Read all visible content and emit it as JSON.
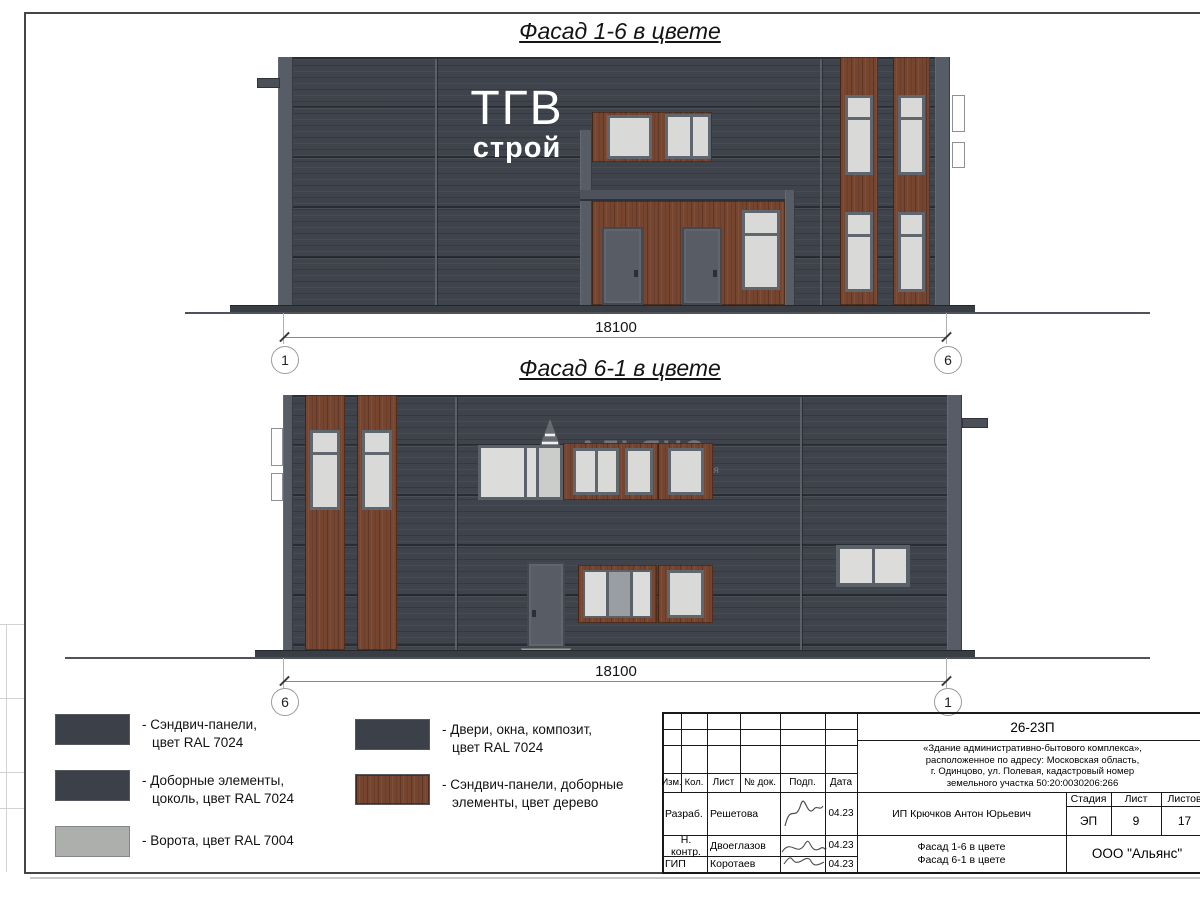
{
  "sheet": {
    "facade1": {
      "title": "Фасад 1-6 в цвете",
      "logo_line1": "ТГВ",
      "logo_line2": "строй",
      "dimension": "18100",
      "axis_left": "1",
      "axis_right": "6"
    },
    "facade2": {
      "title": "Фасад 6-1 в цвете",
      "watermark_name": "АЛЬЯНС",
      "watermark_tagline": "строительная компания",
      "dimension": "18100",
      "axis_left": "6",
      "axis_right": "1"
    },
    "colors": {
      "panel_dark": "#3f444c",
      "wood": "#76452f",
      "gate_gray": "#acafac",
      "glass": "#d9dad8"
    },
    "legend": {
      "items": [
        {
          "line1": "- Сэндвич-панели,",
          "line2": "цвет RAL 7024",
          "swatch": "#3c4149"
        },
        {
          "line1": "- Доборные элементы,",
          "line2": "цоколь, цвет RAL 7024",
          "swatch": "#3c4149"
        },
        {
          "line1": "- Ворота, цвет RAL 7004",
          "line2": "",
          "swatch": "#acafac"
        },
        {
          "line1": "- Двери, окна, композит,",
          "line2": "цвет RAL 7024",
          "swatch": "#3c4149"
        },
        {
          "line1": "- Сэндвич-панели, доборные",
          "line2": "элементы, цвет дерево",
          "swatch": "#76452f"
        }
      ]
    },
    "titleblock": {
      "doc_number": "26-23П",
      "description_line1": "«Здание административно-бытового комплекса»,",
      "description_line2": "расположенное по адресу: Московская область,",
      "description_line3": "г. Одинцово, ул. Полевая, кадастровый номер",
      "description_line4": "земельного участка 50:20:0030206:266",
      "col_izm": "Изм.",
      "col_kol": "Кол.",
      "col_list": "Лист",
      "col_doc": "№ док.",
      "col_podp": "Подп.",
      "col_data": "Дата",
      "row1_role": "Разраб.",
      "row1_name": "Решетова",
      "row1_date": "04.23",
      "row2_role": "Н. контр.",
      "row2_name": "Двоеглазов",
      "row2_date": "04.23",
      "row3_role": "ГИП",
      "row3_name": "Коротаев",
      "row3_date": "04.23",
      "client": "ИП Крючков Антон Юрьевич",
      "stage_label": "Стадия",
      "sheet_label": "Лист",
      "sheets_label": "Листов",
      "stage_value": "ЭП",
      "sheet_value": "9",
      "sheets_value": "17",
      "content_line1": "Фасад 1-6 в цвете",
      "content_line2": "Фасад 6-1 в цвете",
      "company": "ООО \"Альянс\""
    }
  }
}
